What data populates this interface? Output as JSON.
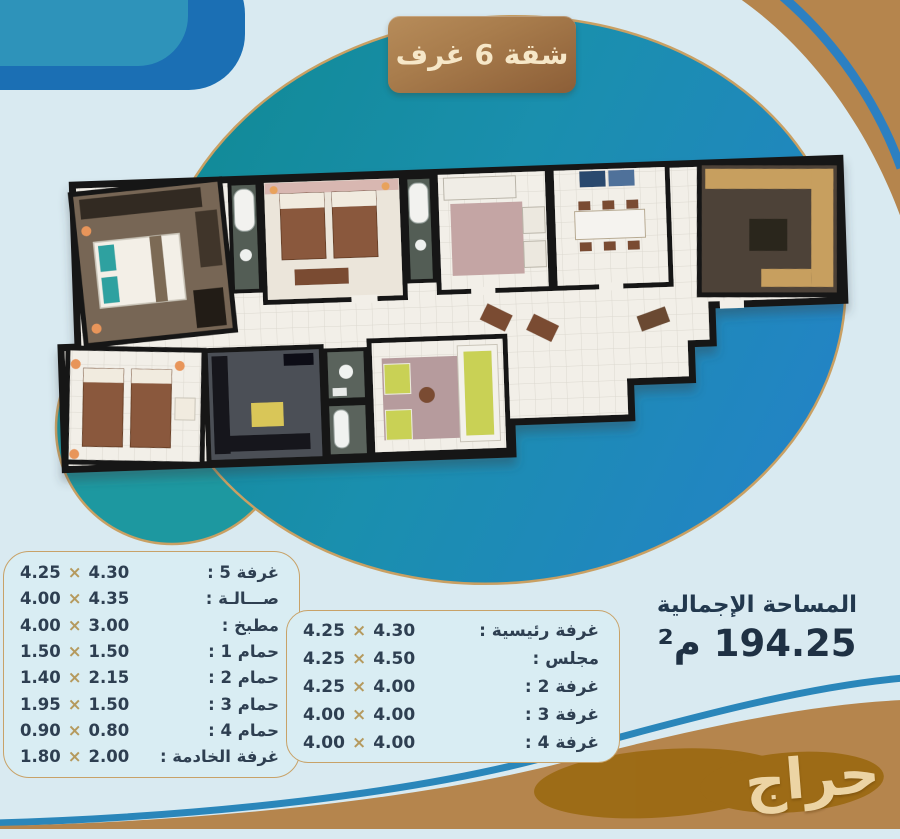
{
  "badge": {
    "label": "شقة 6 غرف"
  },
  "symbols": {
    "times": "×"
  },
  "rooms_left": {
    "rows": [
      {
        "label": "غرفة 5 :",
        "a": "4.25",
        "b": "4.30"
      },
      {
        "label": "صـــالـة :",
        "a": "4.00",
        "b": "4.35"
      },
      {
        "label": "مطبخ :",
        "a": "4.00",
        "b": "3.00"
      },
      {
        "label": "حمام 1 :",
        "a": "1.50",
        "b": "1.50"
      },
      {
        "label": "حمام 2 :",
        "a": "1.40",
        "b": "2.15"
      },
      {
        "label": "حمام 3 :",
        "a": "1.95",
        "b": "1.50"
      },
      {
        "label": "حمام 4 :",
        "a": "0.90",
        "b": "0.80"
      },
      {
        "label": "غرفة الخادمة :",
        "a": "1.80",
        "b": "2.00"
      }
    ]
  },
  "rooms_main": {
    "rows": [
      {
        "label": "غرفة رئيسية :",
        "a": "4.25",
        "b": "4.30"
      },
      {
        "label": "مجلس :",
        "a": "4.25",
        "b": "4.50"
      },
      {
        "label": "غرفة 2 :",
        "a": "4.25",
        "b": "4.00"
      },
      {
        "label": "غرفة 3 :",
        "a": "4.00",
        "b": "4.00"
      },
      {
        "label": "غرفة 4 :",
        "a": "4.00",
        "b": "4.00"
      }
    ]
  },
  "total": {
    "label": "المساحة الإجمالية",
    "value": "194.25 م²"
  },
  "watermark": {
    "text": "حراج"
  },
  "colors": {
    "accent_gold": "#c8a268",
    "teal": "#118a96",
    "blue": "#2383c6",
    "tan_band": "#b5854d",
    "navy_text": "#2e3f51",
    "badge_brown": "#a87c4c"
  }
}
